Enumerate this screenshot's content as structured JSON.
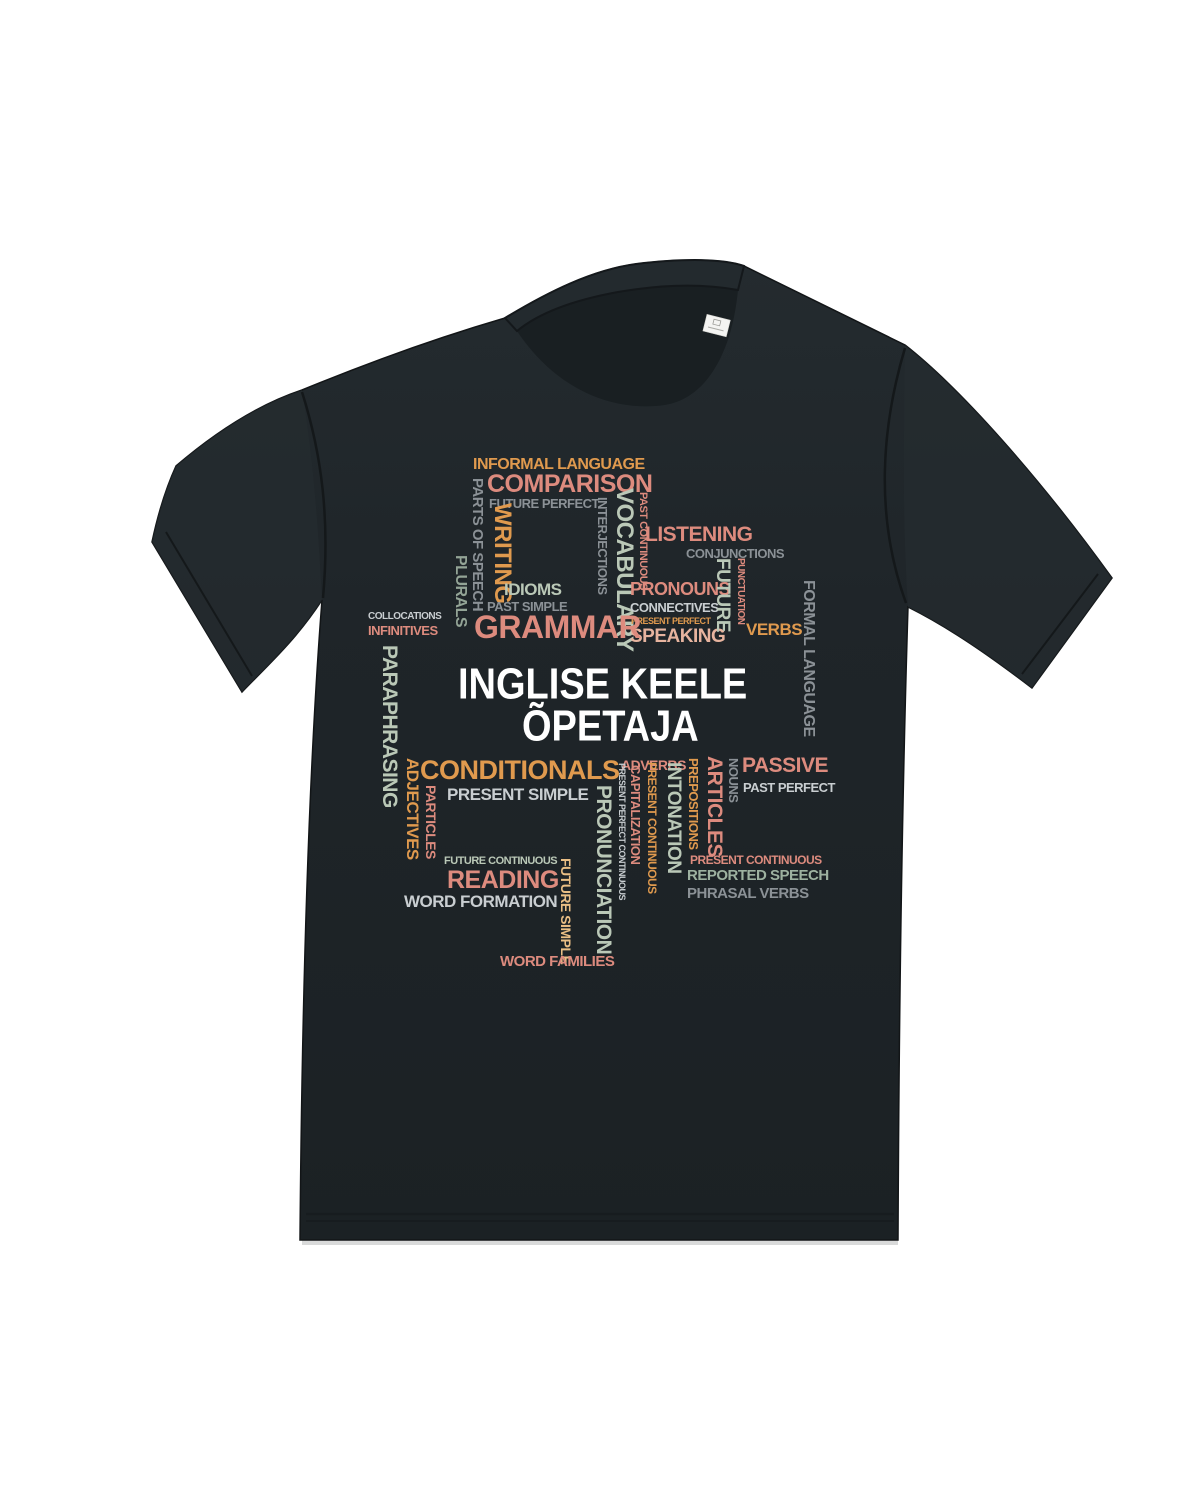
{
  "page": {
    "background": "#ffffff"
  },
  "product": {
    "type": "t-shirt flat-lay photo",
    "shirt_color_name": "black",
    "fabric_color": "#1f2529",
    "neck_label": {
      "visible": true,
      "color": "#f4f4f2"
    }
  },
  "design": {
    "title_line1": "INGLISE KEELE",
    "title_line2": "ÕPETAJA",
    "title_color": "#ffffff",
    "palette": {
      "orange": "#e09a4e",
      "pink": "#dd8b7e",
      "peach": "#e7b49f",
      "apricot": "#eabf85",
      "sage": "#bac8b7",
      "sage_gray": "#9db1a0",
      "plural_green": "#93a496",
      "gray": "#8b9196",
      "light_gray": "#c9ced1",
      "white": "#ffffff"
    },
    "words": [
      {
        "text": "INFORMAL LANGUAGE",
        "color": "#e09a4e"
      },
      {
        "text": "COMPARISON",
        "color": "#dd8b7e"
      },
      {
        "text": "FUTURE PERFECT",
        "color": "#8b9196"
      },
      {
        "text": "PARTS OF SPEECH",
        "color": "#8b9196"
      },
      {
        "text": "WRITING",
        "color": "#e09a4e"
      },
      {
        "text": "INTERJECTIONS",
        "color": "#8b9196"
      },
      {
        "text": "VOCABULARY",
        "color": "#bac8b7"
      },
      {
        "text": "PAST CONTINUOUS",
        "color": "#dd8b7e"
      },
      {
        "text": "LISTENING",
        "color": "#dd8b7e"
      },
      {
        "text": "CONJUNCTIONS",
        "color": "#8b9196"
      },
      {
        "text": "PLURALS",
        "color": "#93a496"
      },
      {
        "text": "IDIOMS",
        "color": "#bac8b7"
      },
      {
        "text": "PAST SIMPLE",
        "color": "#8b9196"
      },
      {
        "text": "PRONOUNS",
        "color": "#dd8b7e"
      },
      {
        "text": "CONNECTIVES",
        "color": "#c9ced1"
      },
      {
        "text": "PRESENT PERFECT",
        "color": "#e09a4e"
      },
      {
        "text": "SPEAKING",
        "color": "#e7b49f"
      },
      {
        "text": "FUTURE",
        "color": "#bac8b7"
      },
      {
        "text": "PUNCTUATION",
        "color": "#dd8b7e"
      },
      {
        "text": "VERBS",
        "color": "#e09a4e"
      },
      {
        "text": "FORMAL LANGUAGE",
        "color": "#8b9196"
      },
      {
        "text": "COLLOCATIONS",
        "color": "#c9ced1"
      },
      {
        "text": "INFINITIVES",
        "color": "#dd8b7e"
      },
      {
        "text": "GRAMMAR",
        "color": "#dd8b7e"
      },
      {
        "text": "PARAPHRASING",
        "color": "#bac8b7"
      },
      {
        "text": "CONDITIONALS",
        "color": "#e09a4e"
      },
      {
        "text": "ADVERBS",
        "color": "#dd8b7e"
      },
      {
        "text": "PRESENT SIMPLE",
        "color": "#c9ced1"
      },
      {
        "text": "ADJECTIVES",
        "color": "#e09a4e"
      },
      {
        "text": "PARTICLES",
        "color": "#dd8b7e"
      },
      {
        "text": "PASSIVE",
        "color": "#dd8b7e"
      },
      {
        "text": "PAST PERFECT",
        "color": "#c9ced1"
      },
      {
        "text": "NOUNS",
        "color": "#8b9196"
      },
      {
        "text": "ARTICLES",
        "color": "#dd8b7e"
      },
      {
        "text": "PREPOSITIONS",
        "color": "#e09a4e"
      },
      {
        "text": "INTONATION",
        "color": "#bac8b7"
      },
      {
        "text": "PRESENT CONTINUOUS",
        "color": "#e09a4e"
      },
      {
        "text": "CAPITALIZATION",
        "color": "#dd8b7e"
      },
      {
        "text": "PRESENT PERFECT CONTINUOUS",
        "color": "#c9ced1"
      },
      {
        "text": "PRONUNCIATION",
        "color": "#bac8b7"
      },
      {
        "text": "FUTURE CONTINUOUS",
        "color": "#bac8b7"
      },
      {
        "text": "READING",
        "color": "#dd8b7e"
      },
      {
        "text": "WORD FORMATION",
        "color": "#c9ced1"
      },
      {
        "text": "FUTURE SIMPLE",
        "color": "#eabf85"
      },
      {
        "text": "PRESENT CONTINUOUS",
        "color": "#dd8b7e"
      },
      {
        "text": "REPORTED SPEECH",
        "color": "#9db1a0"
      },
      {
        "text": "PHRASAL VERBS",
        "color": "#8b9196"
      },
      {
        "text": "WORD FAMILIES",
        "color": "#dd8b7e"
      }
    ]
  }
}
